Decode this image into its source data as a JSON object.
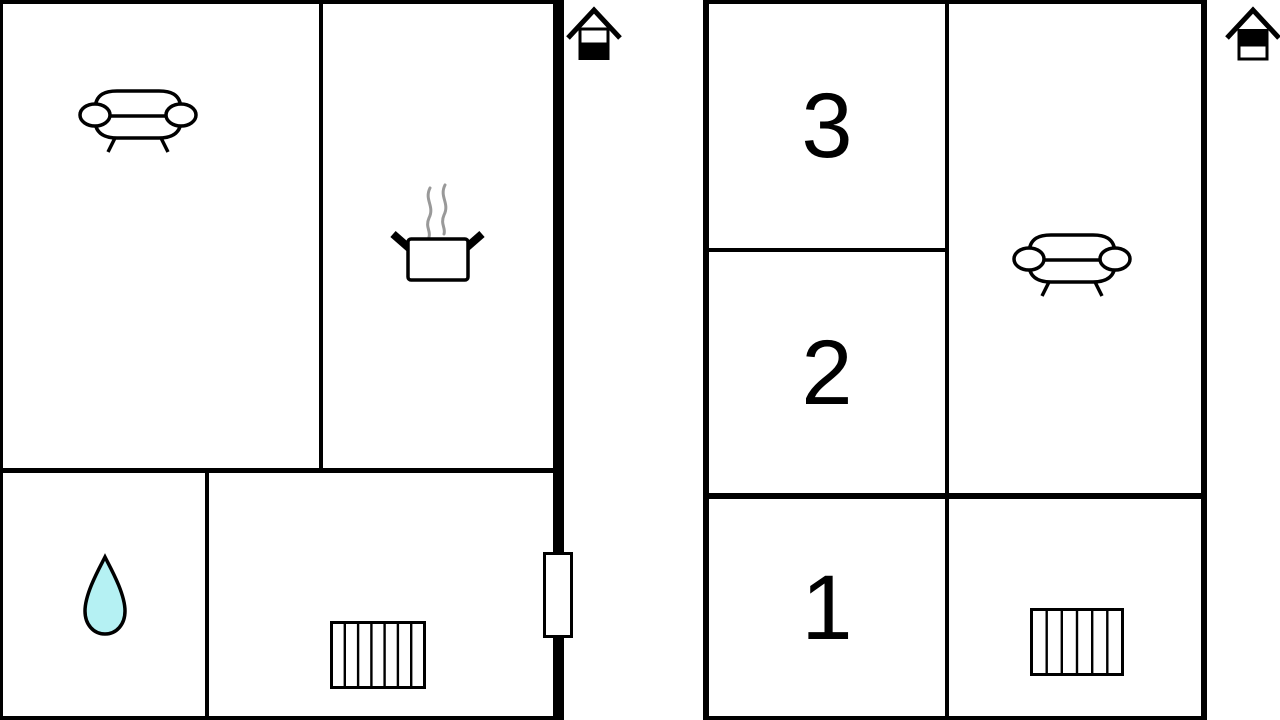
{
  "diagram": {
    "type": "floor-plan",
    "floors": [
      {
        "name": "ground-floor",
        "position": "left",
        "level_marker": "house-icon-bottom-half-filled",
        "features": [
          "sofa",
          "steaming-pot",
          "water-drop",
          "stairs",
          "door"
        ]
      },
      {
        "name": "upper-floor",
        "position": "right",
        "level_marker": "house-icon-top-half-filled",
        "rooms": [
          {
            "label": "3"
          },
          {
            "label": "2"
          },
          {
            "label": "1"
          }
        ],
        "features": [
          "sofa",
          "stairs"
        ]
      }
    ]
  },
  "colors": {
    "wall": "#000000",
    "background": "#ffffff",
    "water_drop_fill": "#b5f1f3",
    "steam": "#999999"
  }
}
